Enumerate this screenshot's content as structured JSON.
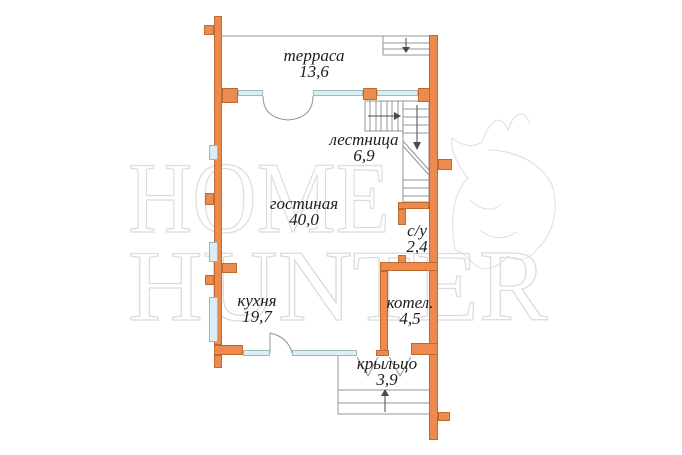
{
  "plan": {
    "title": "first-floor-plan",
    "watermark": {
      "line1": "HOME",
      "line2": "HUNTER"
    },
    "rooms": [
      {
        "id": "terrace",
        "label": "терраса",
        "area": "13,6"
      },
      {
        "id": "stairs",
        "label": "лестница",
        "area": "6,9"
      },
      {
        "id": "living",
        "label": "гостиная",
        "area": "40,0"
      },
      {
        "id": "bathroom",
        "label": "с/у",
        "area": "2,4"
      },
      {
        "id": "kitchen",
        "label": "кухня",
        "area": "19,7"
      },
      {
        "id": "boiler",
        "label": "котел.",
        "area": "4,5"
      },
      {
        "id": "porch",
        "label": "крыльцо",
        "area": "3,9"
      }
    ],
    "colors": {
      "wall": "#ED8A4D",
      "wall_border": "#BE6A31",
      "window": "#D9EEF5",
      "window_border": "#9FB6BD",
      "thin_line": "#949494",
      "arrow": "#4a4a4a",
      "text": "#1c1c1c",
      "watermark": "#dcdcdc",
      "background": "#ffffff"
    }
  }
}
